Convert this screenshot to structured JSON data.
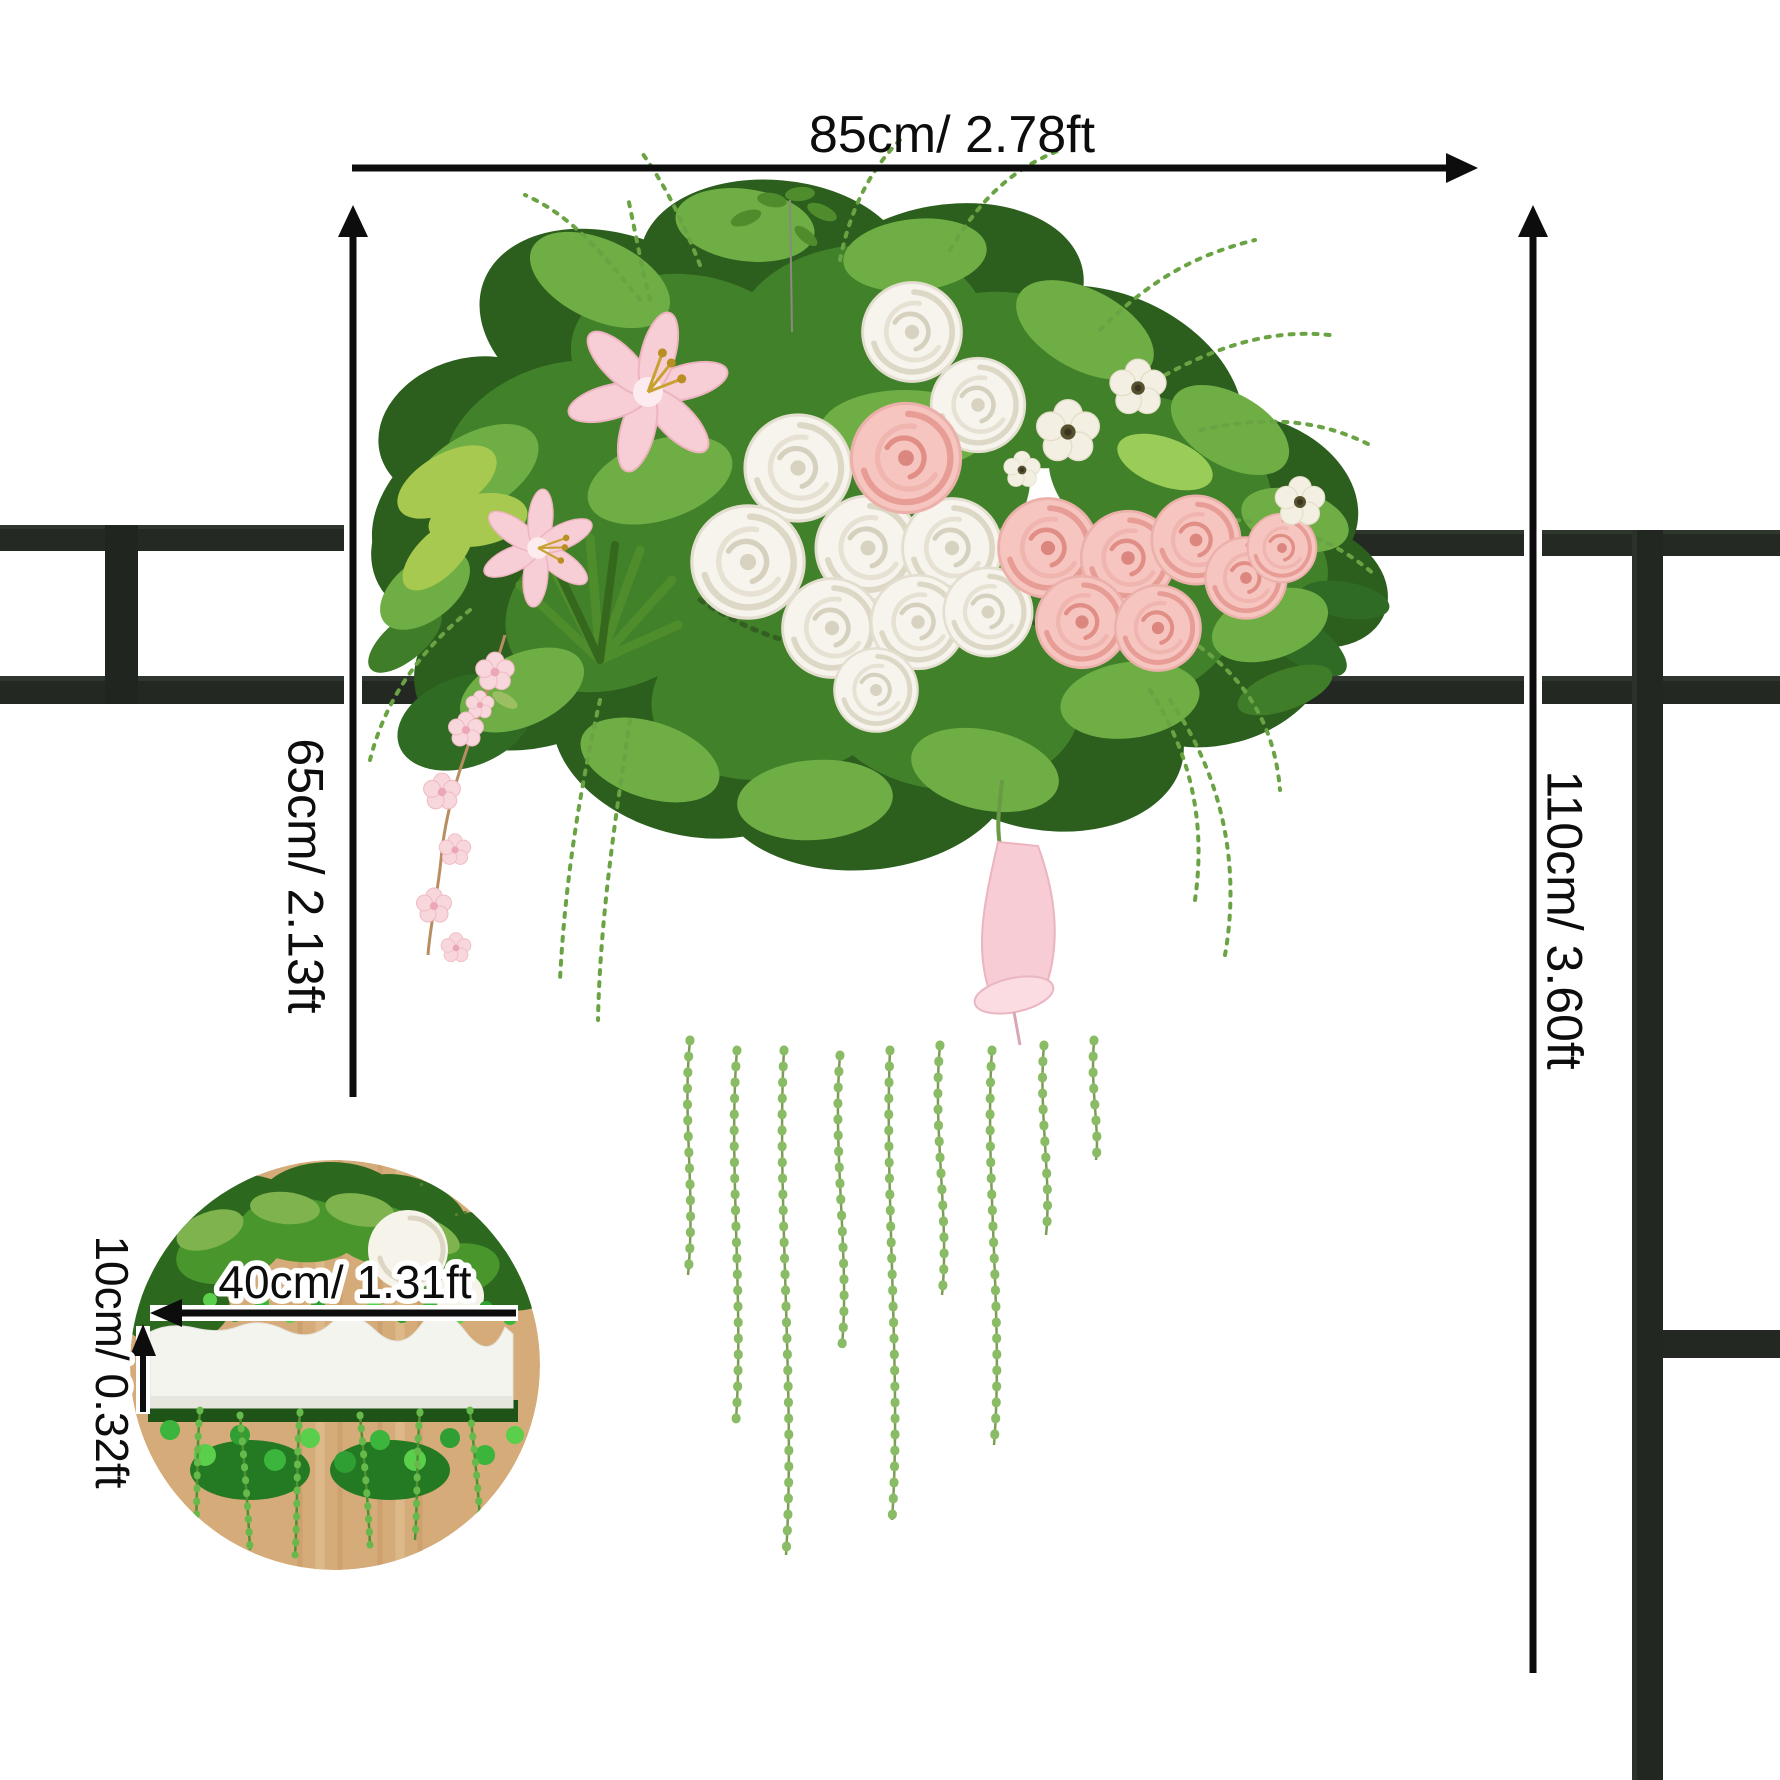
{
  "diagram": {
    "labels": {
      "width": "85cm/ 2.78ft",
      "height_left": "65cm/ 2.13ft",
      "height_right": "110cm/ 3.60ft",
      "inset_width": "40cm/ 1.31ft",
      "inset_height": "10cm/ 0.32ft"
    },
    "colors": {
      "background": "#ffffff",
      "annotation_ink": "#0d0d0d",
      "metal_frame": "#242a23",
      "foliage_dark": "#2c5e1d",
      "foliage_mid": "#41812a",
      "foliage_light": "#6fae45",
      "rose_white": "#f6f4ed",
      "rose_pink": "#f6c5c0",
      "lily_pink": "#f8ced6",
      "wood": "#d4ab79",
      "foam_white": "#f4f4ef"
    }
  }
}
